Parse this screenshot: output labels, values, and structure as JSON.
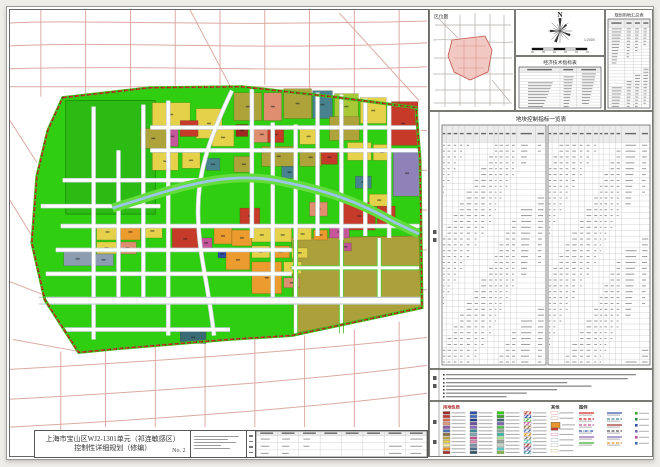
{
  "doc": {
    "title_line1": "上海市宝山区WJ2-1301单元（祁连敏感区）",
    "title_line2": "控制性详细规划（修编）",
    "sheet_no": "No. 2"
  },
  "panels": {
    "location_map_title": "区位图",
    "north_label": "N",
    "scale_label": "1:2000",
    "econ_table_title": "经济技术指标表",
    "landuse_summary_title": "规划用地汇总表",
    "plot_control_title": "地块控制指标一览表",
    "legend_header_landuse": "用地性质",
    "legend_header_other": "其他",
    "legend_header_symbols": "图例"
  },
  "legend": {
    "fill_columns": [
      [
        "#9E2B25",
        "#C53A2E",
        "#D96A4A",
        "#E39B7E",
        "#8E5BA8",
        "#4F6FB5",
        "#8A6E3C",
        "#B5A642",
        "#E8D44D",
        "#F2E89A",
        "#E8952F",
        "#A83226"
      ],
      [
        "#2E4FA8",
        "#3C6CC0",
        "#1F3C8A",
        "#6A4FA0",
        "#8A6BC0",
        "#3E8A99",
        "#7FA8B5",
        "#C0508F",
        "#E08AB5",
        "#7C93A8",
        "#4A6E8A",
        "#2F5566"
      ],
      [
        "#2FD10A",
        "#35A826",
        "#3D6B75",
        "#7B68B0",
        "#55C055",
        "#8AA899",
        "#30C0B0",
        "#A8E08A",
        "#9AA8A0",
        "#C8D8C8",
        "#5AC8C0",
        "#88C040"
      ]
    ],
    "hatch_column": [
      "#C53A2E",
      "#2E4FA8",
      "#35A826",
      "#C0508F",
      "#8A6E3C",
      "#4F6FB5",
      "#E8952F",
      "#777777",
      "#30C0B0",
      "#9E2B25",
      "#6A4FA0",
      "#3E8A99"
    ],
    "other_column": [
      {
        "type": "outline",
        "color": "#D98A80"
      },
      {
        "type": "outline",
        "color": "#C08080"
      },
      {
        "type": "fill-big",
        "color": "#E8952F"
      },
      {
        "type": "fill",
        "color": "#C53A2E"
      },
      {
        "type": "outline",
        "color": "#C060A0"
      },
      {
        "type": "outline",
        "color": "#8090C0"
      },
      {
        "type": "outline",
        "color": "#A0A0A0"
      },
      {
        "type": "outline",
        "color": "#C0A060"
      }
    ],
    "line_columns": [
      [
        {
          "style": "solid",
          "color": "#D42020"
        },
        {
          "style": "dash",
          "color": "#D42020"
        },
        {
          "style": "dash",
          "color": "#C0508F"
        },
        {
          "style": "dashdot",
          "color": "#2E4FA8"
        },
        {
          "style": "solid",
          "color": "#8E5BA8"
        },
        {
          "style": "solid",
          "color": "#35A826"
        }
      ],
      [
        {
          "style": "solid",
          "color": "#2E4FA8"
        },
        {
          "style": "dash",
          "color": "#3E8A99"
        },
        {
          "style": "solid",
          "color": "#9E2B25"
        },
        {
          "style": "dash",
          "color": "#555555"
        },
        {
          "style": "solid",
          "color": "#7B68B0"
        },
        {
          "style": "dash",
          "color": "#E8952F"
        }
      ]
    ],
    "symbol_column": [
      "#35A826",
      "#2E8A3C",
      "#2E4FA8",
      "#7B68B0",
      "#C0508F",
      "#3C6CC0"
    ]
  },
  "map": {
    "base_green": "#30CE10",
    "big_green_parcel": "#2CBB12",
    "olive_zone": "#ABA03A",
    "river": "#9CC4E8",
    "boundary_color": "#D42020",
    "palette": {
      "Y": "#E6D24A",
      "O": "#AEA23B",
      "R": "#C53A28",
      "DR": "#9E2820",
      "S": "#DF8F70",
      "OR": "#EC9C2E",
      "M": "#C5569A",
      "L": "#8F82B8",
      "T": "#47828E",
      "N": "#2F4BA8",
      "GB": "#8C9DB0",
      "SL": "#3A6A74",
      "YG": "#A8C838"
    },
    "parcels": [
      [
        152,
        102,
        38,
        24,
        "Y"
      ],
      [
        196,
        108,
        26,
        30,
        "Y"
      ],
      [
        234,
        92,
        28,
        28,
        "O"
      ],
      [
        264,
        92,
        18,
        28,
        "S"
      ],
      [
        284,
        88,
        28,
        30,
        "O"
      ],
      [
        313,
        90,
        20,
        28,
        "T"
      ],
      [
        335,
        93,
        24,
        26,
        "YG"
      ],
      [
        361,
        97,
        26,
        26,
        "Y"
      ],
      [
        389,
        101,
        30,
        44,
        "R"
      ],
      [
        140,
        128,
        26,
        20,
        "O"
      ],
      [
        166,
        126,
        12,
        20,
        "M"
      ],
      [
        180,
        120,
        18,
        16,
        "R"
      ],
      [
        212,
        128,
        22,
        18,
        "Y"
      ],
      [
        236,
        124,
        12,
        12,
        "DR"
      ],
      [
        252,
        126,
        20,
        16,
        "S"
      ],
      [
        268,
        126,
        16,
        16,
        "R"
      ],
      [
        262,
        146,
        34,
        20,
        "O"
      ],
      [
        300,
        128,
        18,
        16,
        "Y"
      ],
      [
        300,
        148,
        22,
        18,
        "O"
      ],
      [
        330,
        116,
        30,
        24,
        "O"
      ],
      [
        348,
        142,
        24,
        18,
        "Y"
      ],
      [
        374,
        144,
        18,
        16,
        "Y"
      ],
      [
        394,
        150,
        28,
        46,
        "L"
      ],
      [
        152,
        152,
        26,
        18,
        "Y"
      ],
      [
        182,
        152,
        18,
        16,
        "Y"
      ],
      [
        206,
        158,
        14,
        12,
        "T"
      ],
      [
        234,
        156,
        20,
        16,
        "O"
      ],
      [
        282,
        166,
        16,
        12,
        "T"
      ],
      [
        322,
        150,
        16,
        14,
        "R"
      ],
      [
        356,
        176,
        16,
        12,
        "T"
      ],
      [
        240,
        208,
        20,
        16,
        "R"
      ],
      [
        310,
        202,
        18,
        14,
        "S"
      ],
      [
        344,
        202,
        32,
        28,
        "R"
      ],
      [
        378,
        206,
        18,
        20,
        "R"
      ],
      [
        370,
        194,
        20,
        12,
        "Y"
      ],
      [
        330,
        226,
        20,
        12,
        "M"
      ],
      [
        96,
        224,
        22,
        16,
        "Y"
      ],
      [
        120,
        224,
        20,
        16,
        "OR"
      ],
      [
        142,
        224,
        20,
        14,
        "Y"
      ],
      [
        96,
        242,
        20,
        12,
        "Y"
      ],
      [
        118,
        242,
        18,
        12,
        "S"
      ],
      [
        172,
        228,
        26,
        22,
        "R"
      ],
      [
        200,
        238,
        12,
        10,
        "M"
      ],
      [
        214,
        228,
        18,
        16,
        "OR"
      ],
      [
        232,
        230,
        20,
        16,
        "OR"
      ],
      [
        252,
        228,
        20,
        14,
        "Y"
      ],
      [
        274,
        228,
        18,
        14,
        "Y"
      ],
      [
        294,
        228,
        18,
        12,
        "Y"
      ],
      [
        314,
        230,
        14,
        10,
        "OR"
      ],
      [
        252,
        246,
        18,
        12,
        "Y"
      ],
      [
        272,
        246,
        18,
        12,
        "OR"
      ],
      [
        292,
        248,
        16,
        10,
        "Y"
      ],
      [
        226,
        250,
        24,
        20,
        "OR"
      ],
      [
        252,
        262,
        30,
        32,
        "OR"
      ],
      [
        284,
        262,
        18,
        12,
        "Y"
      ],
      [
        284,
        278,
        16,
        10,
        "S"
      ],
      [
        63,
        252,
        28,
        14,
        "GB"
      ],
      [
        93,
        254,
        20,
        12,
        "GB"
      ],
      [
        218,
        250,
        8,
        8,
        "N"
      ],
      [
        180,
        332,
        26,
        12,
        "SL"
      ],
      [
        340,
        243,
        12,
        8,
        "M"
      ]
    ]
  }
}
